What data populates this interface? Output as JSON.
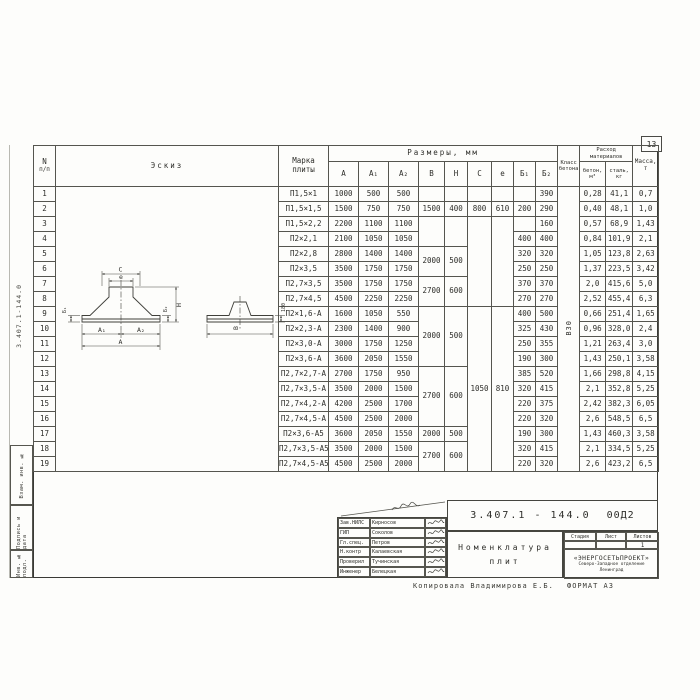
{
  "page": {
    "number": "13"
  },
  "margin": {
    "doc_number_vertical": "3.407.1-144.0",
    "stamps": [
      "Взам. инв. №",
      "Подпись и дата",
      "Инв. № подл."
    ]
  },
  "table": {
    "headers": {
      "num_l1": "N",
      "num_l2": "п/п",
      "sketch": "Эскиз",
      "mark_l1": "Марка",
      "mark_l2": "плиты",
      "sizes": "Размеры, мм",
      "size_cols": [
        "A",
        "A₁",
        "A₂",
        "B",
        "H",
        "C",
        "e",
        "Б₁",
        "Б₂"
      ],
      "class_l1": "Класс",
      "class_l2": "бетона",
      "cons_l1": "Расход",
      "cons_l2": "материалов",
      "concrete_l1": "бетон,",
      "concrete_l2": "м³",
      "steel_l1": "сталь,",
      "steel_l2": "кг",
      "mass_l1": "Масса,",
      "mass_l2": "т"
    },
    "concrete_class": "В30",
    "rows": [
      {
        "n": "1",
        "mark": "П1,5×1",
        "a": "1000",
        "a1": "500",
        "a2": "500",
        "b": [
          "",
          1
        ],
        "h": [
          "",
          1
        ],
        "c": [
          "",
          1
        ],
        "e": [
          "",
          1
        ],
        "b1": "",
        "b2": "390",
        "conc": "0,28",
        "steel": "41,1",
        "mass": "0,7"
      },
      {
        "n": "2",
        "mark": "П1,5×1,5",
        "a": "1500",
        "a1": "750",
        "a2": "750",
        "b": [
          "1500",
          1
        ],
        "h": [
          "400",
          1
        ],
        "c": [
          "800",
          1
        ],
        "e": [
          "610",
          1
        ],
        "b1": "200",
        "b2": "290",
        "conc": "0,40",
        "steel": "48,1",
        "mass": "1,0"
      },
      {
        "n": "3",
        "mark": "П1,5×2,2",
        "a": "2200",
        "a1": "1100",
        "a2": "1100",
        "b": [
          "",
          2
        ],
        "h": [
          "",
          2
        ],
        "c": [
          "",
          6
        ],
        "e": [
          "",
          6
        ],
        "b1": "",
        "b2": "160",
        "conc": "0,57",
        "steel": "68,9",
        "mass": "1,43"
      },
      {
        "n": "4",
        "mark": "П2×2,1",
        "a": "2100",
        "a1": "1050",
        "a2": "1050",
        "b": null,
        "h": null,
        "c": null,
        "e": null,
        "b1": "400",
        "b2": "400",
        "conc": "0,84",
        "steel": "101,9",
        "mass": "2,1"
      },
      {
        "n": "5",
        "mark": "П2×2,8",
        "a": "2800",
        "a1": "1400",
        "a2": "1400",
        "b": [
          "2000",
          2
        ],
        "h": [
          "500",
          2
        ],
        "c": null,
        "e": null,
        "b1": "320",
        "b2": "320",
        "conc": "1,05",
        "steel": "123,8",
        "mass": "2,63"
      },
      {
        "n": "6",
        "mark": "П2×3,5",
        "a": "3500",
        "a1": "1750",
        "a2": "1750",
        "b": null,
        "h": null,
        "c": null,
        "e": null,
        "b1": "250",
        "b2": "250",
        "conc": "1,37",
        "steel": "223,5",
        "mass": "3,42"
      },
      {
        "n": "7",
        "mark": "П2,7×3,5",
        "a": "3500",
        "a1": "1750",
        "a2": "1750",
        "b": [
          "2700",
          2
        ],
        "h": [
          "600",
          2
        ],
        "c": null,
        "e": null,
        "b1": "370",
        "b2": "370",
        "conc": "2,0",
        "steel": "415,6",
        "mass": "5,0"
      },
      {
        "n": "8",
        "mark": "П2,7×4,5",
        "a": "4500",
        "a1": "2250",
        "a2": "2250",
        "b": null,
        "h": null,
        "c": null,
        "e": null,
        "b1": "270",
        "b2": "270",
        "conc": "2,52",
        "steel": "455,4",
        "mass": "6,3"
      },
      {
        "n": "9",
        "mark": "П2×1,6-А",
        "a": "1600",
        "a1": "1050",
        "a2": "550",
        "b": [
          "2000",
          4
        ],
        "h": [
          "500",
          4
        ],
        "c": [
          "1050",
          11
        ],
        "e": [
          "810",
          11
        ],
        "b1": "400",
        "b2": "500",
        "conc": "0,66",
        "steel": "251,4",
        "mass": "1,65"
      },
      {
        "n": "10",
        "mark": "П2×2,3-А",
        "a": "2300",
        "a1": "1400",
        "a2": "900",
        "b": null,
        "h": null,
        "c": null,
        "e": null,
        "b1": "325",
        "b2": "430",
        "conc": "0,96",
        "steel": "328,0",
        "mass": "2,4"
      },
      {
        "n": "11",
        "mark": "П2×3,0-А",
        "a": "3000",
        "a1": "1750",
        "a2": "1250",
        "b": null,
        "h": null,
        "c": null,
        "e": null,
        "b1": "250",
        "b2": "355",
        "conc": "1,21",
        "steel": "263,4",
        "mass": "3,0"
      },
      {
        "n": "12",
        "mark": "П2×3,6-А",
        "a": "3600",
        "a1": "2050",
        "a2": "1550",
        "b": null,
        "h": null,
        "c": null,
        "e": null,
        "b1": "190",
        "b2": "300",
        "conc": "1,43",
        "steel": "250,1",
        "mass": "3,58"
      },
      {
        "n": "13",
        "mark": "П2,7×2,7-А",
        "a": "2700",
        "a1": "1750",
        "a2": "950",
        "b": [
          "2700",
          4
        ],
        "h": [
          "600",
          4
        ],
        "c": null,
        "e": null,
        "b1": "385",
        "b2": "520",
        "conc": "1,66",
        "steel": "298,8",
        "mass": "4,15"
      },
      {
        "n": "14",
        "mark": "П2,7×3,5-А",
        "a": "3500",
        "a1": "2000",
        "a2": "1500",
        "b": null,
        "h": null,
        "c": null,
        "e": null,
        "b1": "320",
        "b2": "415",
        "conc": "2,1",
        "steel": "352,8",
        "mass": "5,25"
      },
      {
        "n": "15",
        "mark": "П2,7×4,2-А",
        "a": "4200",
        "a1": "2500",
        "a2": "1700",
        "b": null,
        "h": null,
        "c": null,
        "e": null,
        "b1": "220",
        "b2": "375",
        "conc": "2,42",
        "steel": "382,3",
        "mass": "6,05"
      },
      {
        "n": "16",
        "mark": "П2,7×4,5-А",
        "a": "4500",
        "a1": "2500",
        "a2": "2000",
        "b": null,
        "h": null,
        "c": null,
        "e": null,
        "b1": "220",
        "b2": "320",
        "conc": "2,6",
        "steel": "548,5",
        "mass": "6,5"
      },
      {
        "n": "17",
        "mark": "П2×3,6-А5",
        "a": "3600",
        "a1": "2050",
        "a2": "1550",
        "b": [
          "2000",
          1
        ],
        "h": [
          "500",
          1
        ],
        "c": null,
        "e": null,
        "b1": "190",
        "b2": "300",
        "conc": "1,43",
        "steel": "460,3",
        "mass": "3,58"
      },
      {
        "n": "18",
        "mark": "П2,7×3,5-А5",
        "a": "3500",
        "a1": "2000",
        "a2": "1500",
        "b": [
          "2700",
          2
        ],
        "h": [
          "600",
          2
        ],
        "c": null,
        "e": null,
        "b1": "320",
        "b2": "415",
        "conc": "2,1",
        "steel": "334,5",
        "mass": "5,25"
      },
      {
        "n": "19",
        "mark": "П2,7×4,5-А5",
        "a": "4500",
        "a1": "2500",
        "a2": "2000",
        "b": null,
        "h": null,
        "c": null,
        "e": null,
        "b1": "220",
        "b2": "320",
        "conc": "2,6",
        "steel": "423,2",
        "mass": "6,5"
      }
    ]
  },
  "sketch": {
    "labels": {
      "c": "C",
      "e": "e",
      "a1": "A₁",
      "a2": "A₂",
      "a": "A",
      "b": "B",
      "h": "H",
      "b1": "Б₁",
      "b2": "Б₂",
      "edge": "180"
    }
  },
  "titleblock": {
    "doc_number": "3.407.1 - 144.0",
    "doc_suffix": "00Д2",
    "title_l1": "Номенклатура",
    "title_l2": "плит",
    "sheet_cols": [
      "Стадия",
      "Лист",
      "Листов"
    ],
    "sheet_vals": [
      "",
      "",
      "1"
    ],
    "org_l1": "«ЭНЕРГОСЕТЬПРОЕКТ»",
    "org_l2": "Северо-Западное отделение",
    "org_l3": "Ленинград",
    "people": [
      {
        "role": "Зав.НИЛС",
        "name": "Кирносов"
      },
      {
        "role": "ГИП",
        "name": "Соколов"
      },
      {
        "role": "Гл.спец.",
        "name": "Петров"
      },
      {
        "role": "Н.контр",
        "name": "Калаевская"
      },
      {
        "role": "Проверил",
        "name": "Тучинская"
      },
      {
        "role": "Инженер",
        "name": "Белецкая"
      }
    ],
    "copied_by": "Копировала Владимирова Е.Б.",
    "format": "ФОРМАТ А3"
  },
  "colors": {
    "line": "#45453f",
    "ink": "#2e2e2a",
    "paper": "#fdfdfb"
  }
}
